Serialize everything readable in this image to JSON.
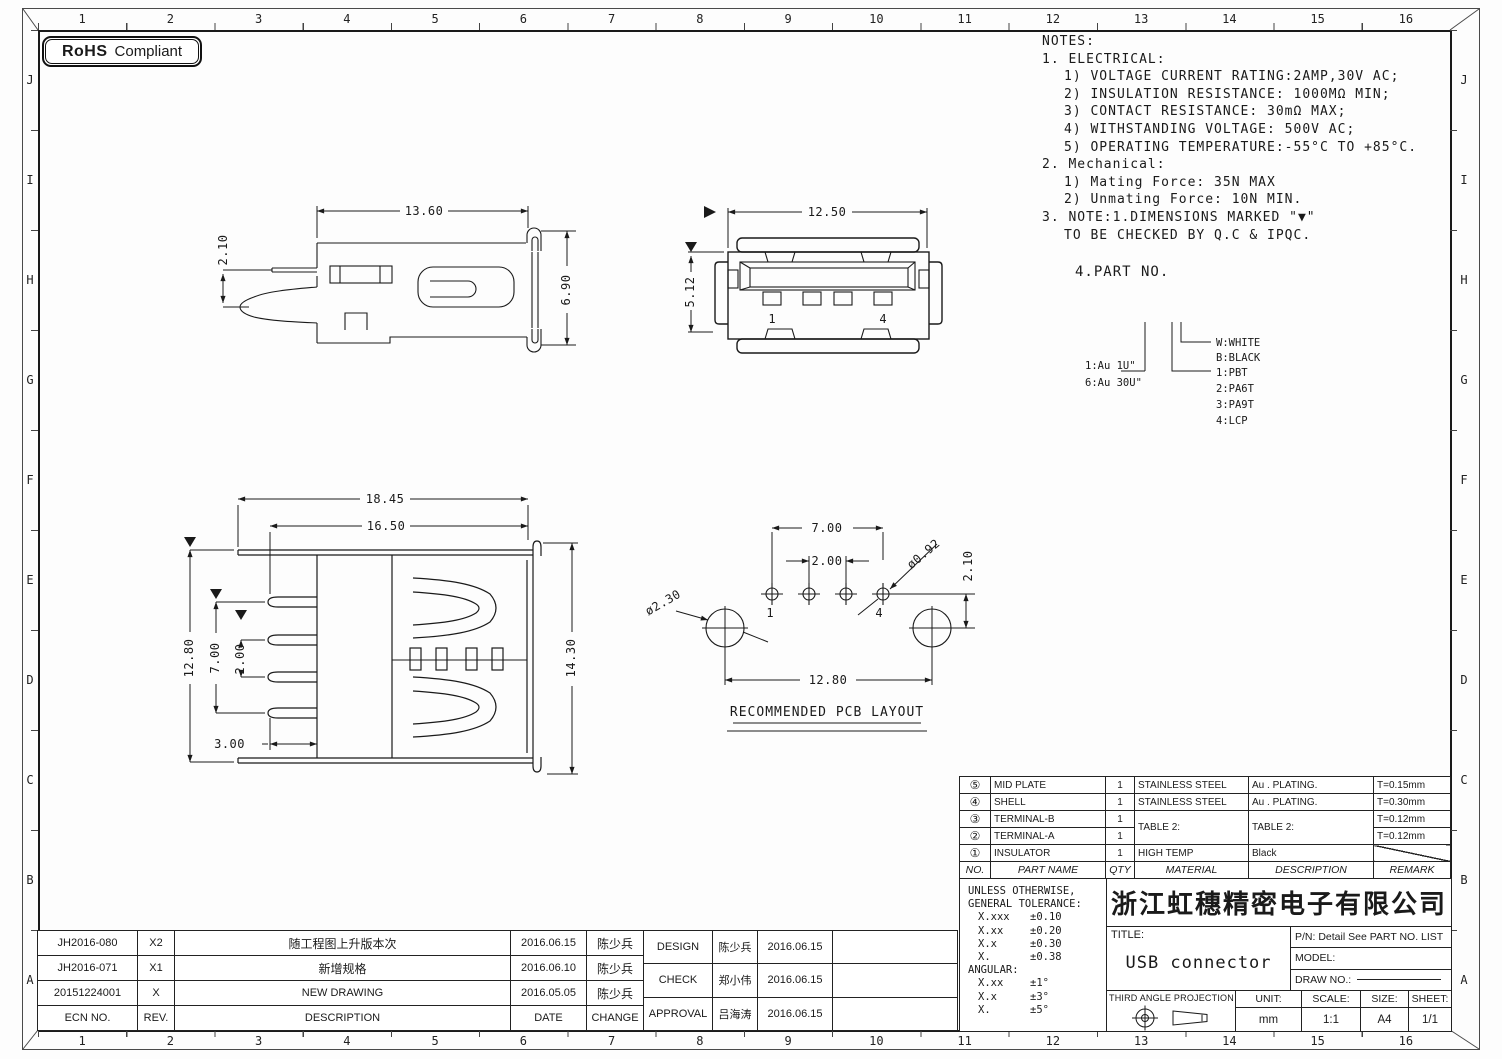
{
  "rohs": {
    "bold": "RoHS",
    "rest": "Compliant"
  },
  "grid": {
    "cols": [
      "1",
      "2",
      "3",
      "4",
      "5",
      "6",
      "7",
      "8",
      "9",
      "10",
      "11",
      "12",
      "13",
      "14",
      "15",
      "16"
    ],
    "rows": [
      "J",
      "I",
      "H",
      "G",
      "F",
      "E",
      "D",
      "C",
      "B",
      "A"
    ]
  },
  "notes": {
    "lines": [
      "NOTES:",
      "1. ELECTRICAL:",
      "1) VOLTAGE CURRENT RATING:2AMP,30V AC;",
      "2) INSULATION RESISTANCE: 1000MΩ MIN;",
      "3) CONTACT RESISTANCE: 30mΩ MAX;",
      "4) WITHSTANDING VOLTAGE: 500V AC;",
      "5) OPERATING TEMPERATURE:-55°C TO +85°C.",
      "2. Mechanical:",
      "1) Mating Force:  35N MAX",
      "2) Unmating Force:  10N MIN.",
      "3. NOTE:1.DIMENSIONS MARKED \"▼\"",
      "TO BE CHECKED BY Q.C & IPQC.",
      "4.PART NO."
    ]
  },
  "legend": {
    "au_1": "1:Au 1U\"",
    "au_6": "6:Au 30U\"",
    "w": "W:WHITE",
    "b": "B:BLACK",
    "m1": "1:PBT",
    "m2": "2:PA6T",
    "m3": "3:PA9T",
    "m4": "4:LCP"
  },
  "views": {
    "side": {
      "dim_w": "13.60",
      "dim_offset": "2.10",
      "dim_h": "6.90"
    },
    "front": {
      "dim_w": "12.50",
      "dim_h": "5.12",
      "pin_first": "1",
      "pin_last": "4"
    },
    "top": {
      "dim_w_outer": "18.45",
      "dim_w_inner": "16.50",
      "dim_h_left": "12.80",
      "dim_pin_span": "7.00",
      "dim_pin_pitch": "2.00",
      "dim_pin_len": "3.00",
      "dim_h_right": "14.30"
    },
    "pcb": {
      "dim_span": "7.00",
      "dim_pitch": "2.00",
      "dim_hole_small": "ø0.92",
      "dim_offset": "2.10",
      "dim_hole_big": "ø2.30",
      "dim_span_big": "12.80",
      "pin_first": "1",
      "pin_last": "4",
      "caption": "RECOMMENDED PCB LAYOUT"
    }
  },
  "parts_table": {
    "headers": {
      "no": "NO.",
      "part": "PART NAME",
      "qty": "QTY",
      "material": "MATERIAL",
      "desc": "DESCRIPTION",
      "remark": "REMARK"
    },
    "rows": [
      {
        "no": "⑤",
        "part": "MID PLATE",
        "qty": "1",
        "material": "STAINLESS STEEL",
        "desc": "Au . PLATING.",
        "remark": "T=0.15mm"
      },
      {
        "no": "④",
        "part": "SHELL",
        "qty": "1",
        "material": "STAINLESS STEEL",
        "desc": "Au . PLATING.",
        "remark": "T=0.30mm"
      },
      {
        "no": "③",
        "part": "TERMINAL-B",
        "qty": "1",
        "material": "TABLE 2:",
        "desc": "TABLE 2:",
        "remark": "T=0.12mm"
      },
      {
        "no": "②",
        "part": "TERMINAL-A",
        "qty": "1",
        "remark": "T=0.12mm"
      },
      {
        "no": "①",
        "part": "INSULATOR",
        "qty": "1",
        "material": "HIGH TEMP",
        "desc": "Black",
        "remark": ""
      }
    ]
  },
  "tolerance": {
    "line1": "UNLESS OTHERWISE,",
    "line2": "GENERAL TOLERANCE:",
    "rows": [
      {
        "k": "X.xxx",
        "v": "±0.10"
      },
      {
        "k": "X.xx",
        "v": "±0.20"
      },
      {
        "k": "X.x",
        "v": "±0.30"
      },
      {
        "k": "X.",
        "v": "±0.38"
      }
    ],
    "angular": "ANGULAR:",
    "angular_rows": [
      {
        "k": "X.xx",
        "v": "±1°"
      },
      {
        "k": "X.x",
        "v": "±3°"
      },
      {
        "k": "X.",
        "v": "±5°"
      }
    ]
  },
  "title_block": {
    "company": "浙江虹穗精密电子有限公司",
    "title_label": "TITLE:",
    "title_value": "USB connector",
    "pn": "P/N: Detail See PART NO. LIST",
    "model_label": "MODEL:",
    "draw_no_label": "DRAW NO.:",
    "projection_label": "THIRD ANGLE PROJECTION",
    "unit_label": "UNIT:",
    "unit_value": "mm",
    "scale_label": "SCALE:",
    "scale_value": "1:1",
    "size_label": "SIZE:",
    "size_value": "A4",
    "sheet_label": "SHEET:",
    "sheet_value": "1/1"
  },
  "revisions": {
    "headers": {
      "ecn": "ECN NO.",
      "rev": "REV.",
      "desc": "DESCRIPTION",
      "date": "DATE",
      "change": "CHANGE"
    },
    "rows": [
      {
        "ecn": "JH2016-080",
        "rev": "X2",
        "desc": "随工程图上升版本次",
        "date": "2016.06.15",
        "change": "陈少兵"
      },
      {
        "ecn": "JH2016-071",
        "rev": "X1",
        "desc": "新增规格",
        "date": "2016.06.10",
        "change": "陈少兵"
      },
      {
        "ecn": "20151224001",
        "rev": "X",
        "desc": "NEW DRAWING",
        "date": "2016.05.05",
        "change": "陈少兵"
      }
    ]
  },
  "approvals": {
    "rows": [
      {
        "role": "DESIGN",
        "name": "陈少兵",
        "date": "2016.06.15",
        "extra": ""
      },
      {
        "role": "CHECK",
        "name": "郑小伟",
        "date": "2016.06.15",
        "extra": ""
      },
      {
        "role": "APPROVAL",
        "name": "吕海涛",
        "date": "2016.06.15",
        "extra": ""
      }
    ]
  }
}
